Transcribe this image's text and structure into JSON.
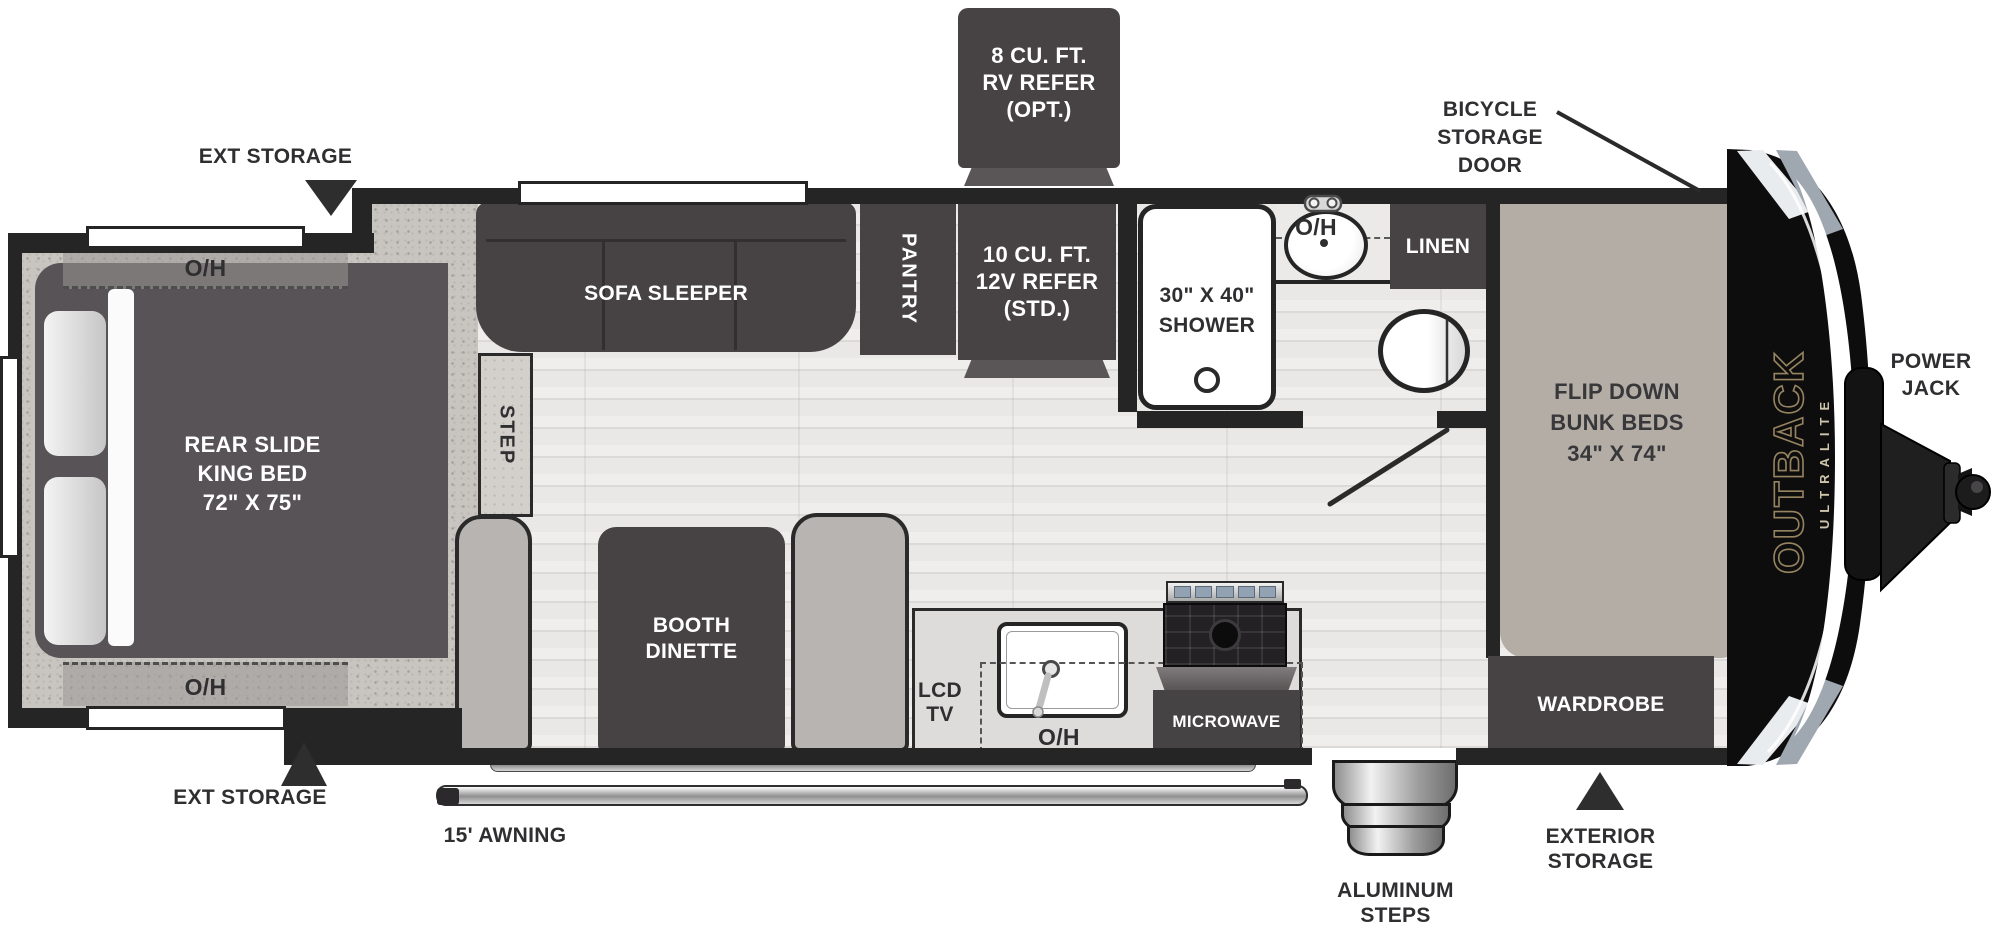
{
  "colors": {
    "wall": "#262526",
    "furniture_dark": "#474345",
    "bed": "#575357",
    "floor": "#e9e8e6",
    "speckle": "#c8c4c0",
    "bench": "#b7b4b1",
    "bunks_pad": "#b3ada6",
    "accent_gold": "#95845f",
    "counter": "#dedcdb"
  },
  "brand": {
    "name": "OUTBACK",
    "sub": "ULTRALITE"
  },
  "exterior": {
    "ext_storage_top": "EXT STORAGE",
    "ext_storage_bottom": "EXT STORAGE",
    "bicycle_door": [
      "BICYCLE",
      "STORAGE",
      "DOOR"
    ],
    "power_jack": [
      "POWER",
      "JACK"
    ],
    "front_storage": [
      "EXTERIOR",
      "STORAGE"
    ],
    "steps": [
      "ALUMINUM",
      "STEPS"
    ],
    "awning": "15' AWNING",
    "refer_optional": [
      "8 CU. FT.",
      "RV REFER",
      "(OPT.)"
    ]
  },
  "bedroom": {
    "bed": [
      "REAR SLIDE",
      "KING BED",
      "72\" X 75\""
    ],
    "overhead_top": "O/H",
    "overhead_bottom": "O/H",
    "step": "STEP"
  },
  "living": {
    "sofa": "SOFA SLEEPER",
    "dinette": [
      "BOOTH",
      "DINETTE"
    ],
    "pantry": "PANTRY",
    "refer_standard": [
      "10 CU. FT.",
      "12V REFER",
      "(STD.)"
    ]
  },
  "kitchen": {
    "tv": [
      "LCD",
      "TV"
    ],
    "overhead": "O/H",
    "microwave": "MICROWAVE"
  },
  "bathroom": {
    "shower": [
      "30\" X 40\"",
      "SHOWER"
    ],
    "overhead": "O/H",
    "linen": "LINEN"
  },
  "front_bedroom": {
    "bunks": [
      "FLIP DOWN",
      "BUNK BEDS",
      "34\" X 74\""
    ],
    "wardrobe": "WARDROBE"
  }
}
